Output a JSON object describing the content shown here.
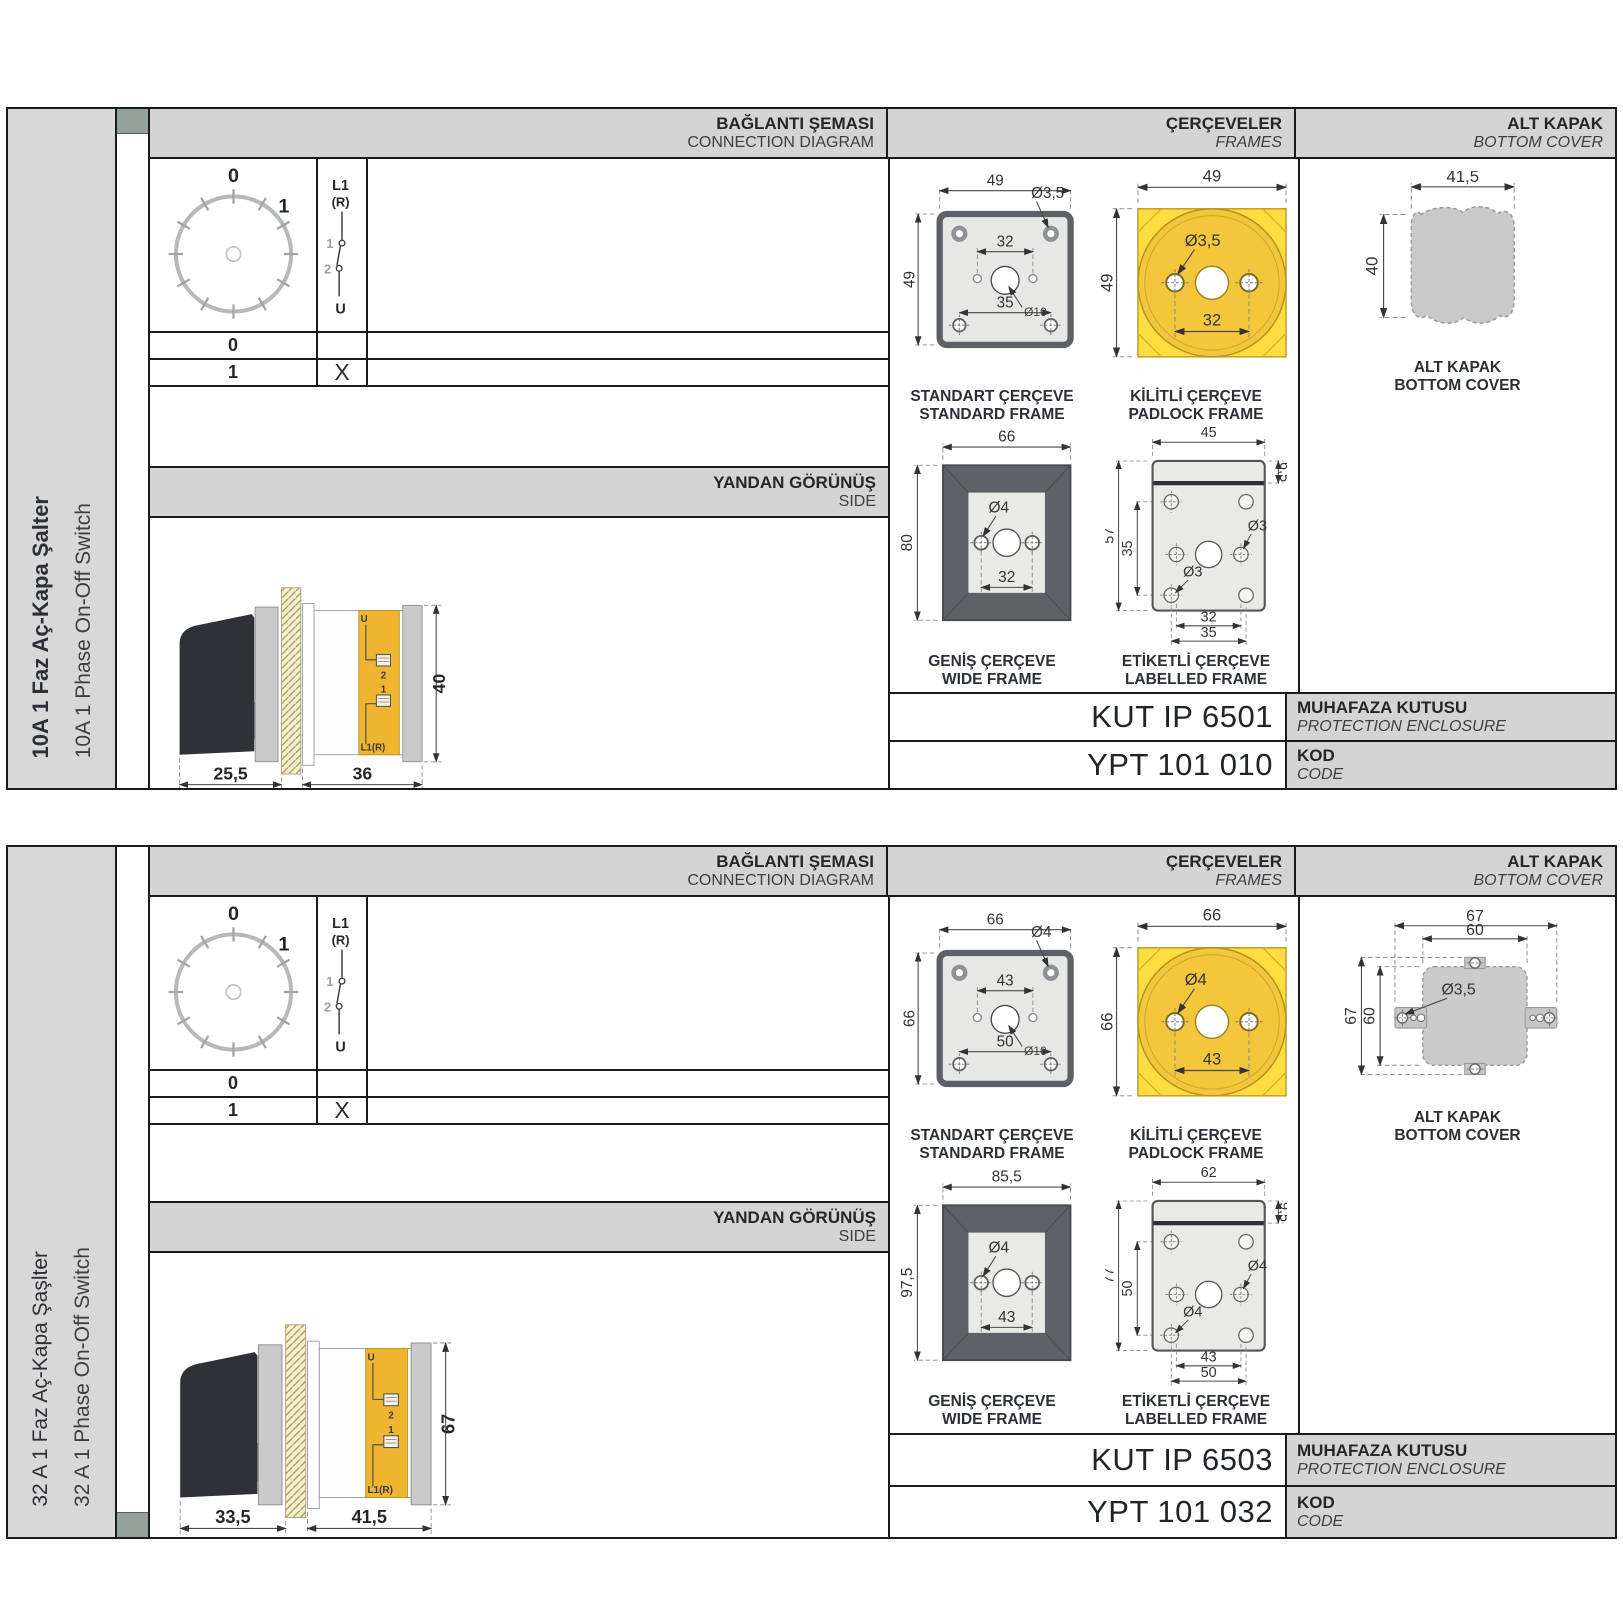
{
  "labels": {
    "connection_diagram_tr": "BAĞLANTI ŞEMASI",
    "connection_diagram_en": "CONNECTION DIAGRAM",
    "frames_tr": "ÇERÇEVELER",
    "frames_en": "FRAMES",
    "bottom_cover_tr": "ALT KAPAK",
    "bottom_cover_en": "BOTTOM COVER",
    "side_view_tr": "YANDAN GÖRÜNÜŞ",
    "side_view_en": "SIDE",
    "standard_frame_tr": "STANDART ÇERÇEVE",
    "standard_frame_en": "STANDARD FRAME",
    "padlock_frame_tr": "KİLİTLİ ÇERÇEVE",
    "padlock_frame_en": "PADLOCK FRAME",
    "wide_frame_tr": "GENİŞ ÇERÇEVE",
    "wide_frame_en": "WIDE FRAME",
    "labelled_frame_tr": "ETİKETLİ ÇERÇEVE",
    "labelled_frame_en": "LABELLED FRAME",
    "bottom_cover_caption_tr": "ALT KAPAK",
    "bottom_cover_caption_en": "BOTTOM COVER",
    "protection_enclosure_tr": "MUHAFAZA KUTUSU",
    "protection_enclosure_en": "PROTECTION ENCLOSURE",
    "code_tr": "KOD",
    "code_en": "CODE"
  },
  "connection": {
    "dial_zero": "0",
    "dial_one": "1",
    "feed_line": "L1",
    "feed_phase": "(R)",
    "contact_one": "1",
    "contact_two": "2",
    "load": "U",
    "rows": [
      {
        "position": "0",
        "mark": ""
      },
      {
        "position": "1",
        "mark": "X"
      }
    ],
    "terminals": {
      "u": "U",
      "two": "2",
      "one": "1",
      "l1r": "L1(R)"
    }
  },
  "panel1": {
    "title_tr": "10A 1 Faz Aç-Kapa Şalter",
    "title_en": "10A 1 Phase On-Off Switch",
    "kut_code": "KUT IP 6501",
    "ypt_code": "YPT 101 010",
    "side_view": {
      "front_depth": "25,5",
      "body_depth": "36",
      "body_height": "40"
    },
    "standard_frame": {
      "width": "49",
      "height": "49",
      "top_span": "32",
      "bottom_span": "35",
      "corner_hole": "Ø3,5",
      "center_hole": "Ø10"
    },
    "padlock_frame": {
      "width": "49",
      "height": "49",
      "hole": "Ø3,5",
      "span": "32"
    },
    "wide_frame": {
      "width": "66",
      "height": "80",
      "hole": "Ø4",
      "span": "32"
    },
    "labelled_frame": {
      "width": "45",
      "band_height": "6,5",
      "height": "57",
      "inner_height": "35",
      "hole_right": "Ø3",
      "hole_left": "Ø3",
      "span_inner": "32",
      "span_outer": "35"
    },
    "bottom_cover": {
      "width": "41,5",
      "height": "40"
    }
  },
  "panel2": {
    "title_tr": "32 A 1 Faz Aç-Kapa Şaşlter",
    "title_en": "32 A 1 Phase On-Off Switch",
    "kut_code": "KUT IP 6503",
    "ypt_code": "YPT 101 032",
    "side_view": {
      "front_depth": "33,5",
      "body_depth": "41,5",
      "body_height": "67"
    },
    "standard_frame": {
      "width": "66",
      "height": "66",
      "top_span": "43",
      "bottom_span": "50",
      "corner_hole": "Ø4",
      "center_hole": "Ø10"
    },
    "padlock_frame": {
      "width": "66",
      "height": "66",
      "hole": "Ø4",
      "span": "43"
    },
    "wide_frame": {
      "width": "85,5",
      "height": "97,5",
      "hole": "Ø4",
      "span": "43"
    },
    "labelled_frame": {
      "width": "62",
      "band_height": "9,5",
      "height": "77",
      "inner_height": "50",
      "hole_right": "Ø4",
      "hole_left": "Ø4",
      "span_inner": "43",
      "span_outer": "50"
    },
    "bottom_cover": {
      "outer_width": "67",
      "inner_width": "60",
      "outer_height": "67",
      "inner_height": "60",
      "hole": "Ø3,5"
    }
  },
  "colors": {
    "accent_yellow": "#f3c63c",
    "band_gray": "#d4d4d4",
    "drawing_gray": "#c9c9c9",
    "handle_black": "#2e3236"
  }
}
